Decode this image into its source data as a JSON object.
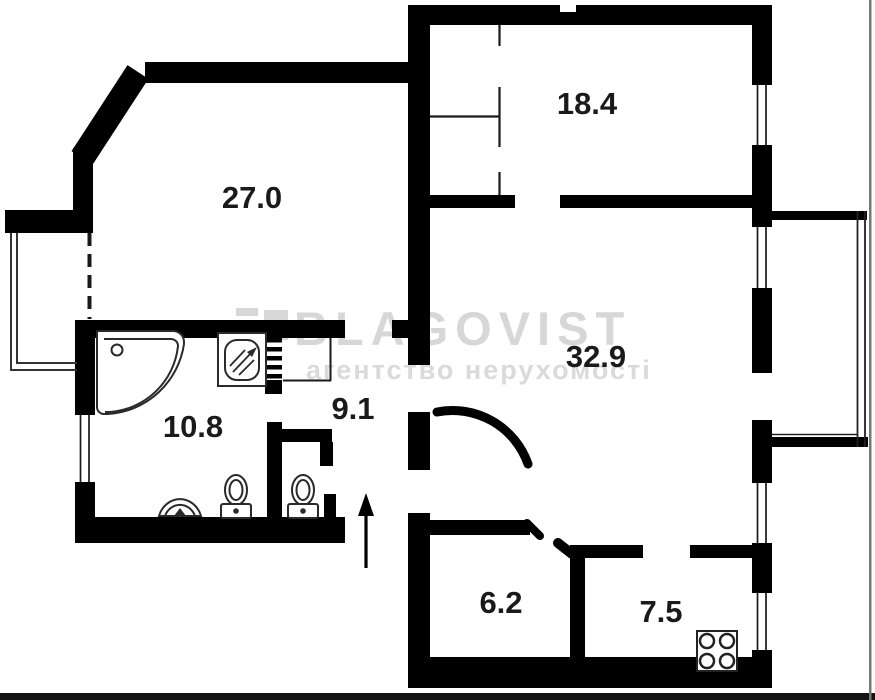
{
  "watermark": {
    "brand": "BLAGOVIST",
    "tagline": "агентство нерухомості"
  },
  "rooms": [
    {
      "label": "27.0"
    },
    {
      "label": "18.4"
    },
    {
      "label": "32.9"
    },
    {
      "label": "10.8"
    },
    {
      "label": "9.1"
    },
    {
      "label": "6.2"
    },
    {
      "label": "7.5"
    }
  ],
  "fixtures": [
    "corner-bathtub",
    "shower-cabin",
    "washbasin",
    "toilet",
    "toilet",
    "gas-stove",
    "ventilation-shaft",
    "entrance-arrow",
    "door-arc"
  ],
  "colors": {
    "wall": "#000000",
    "label": "#1a1a1a",
    "watermark": "#d7d7d7",
    "fixture_stroke": "#2a2a2a",
    "photo_edge": "#777777"
  }
}
